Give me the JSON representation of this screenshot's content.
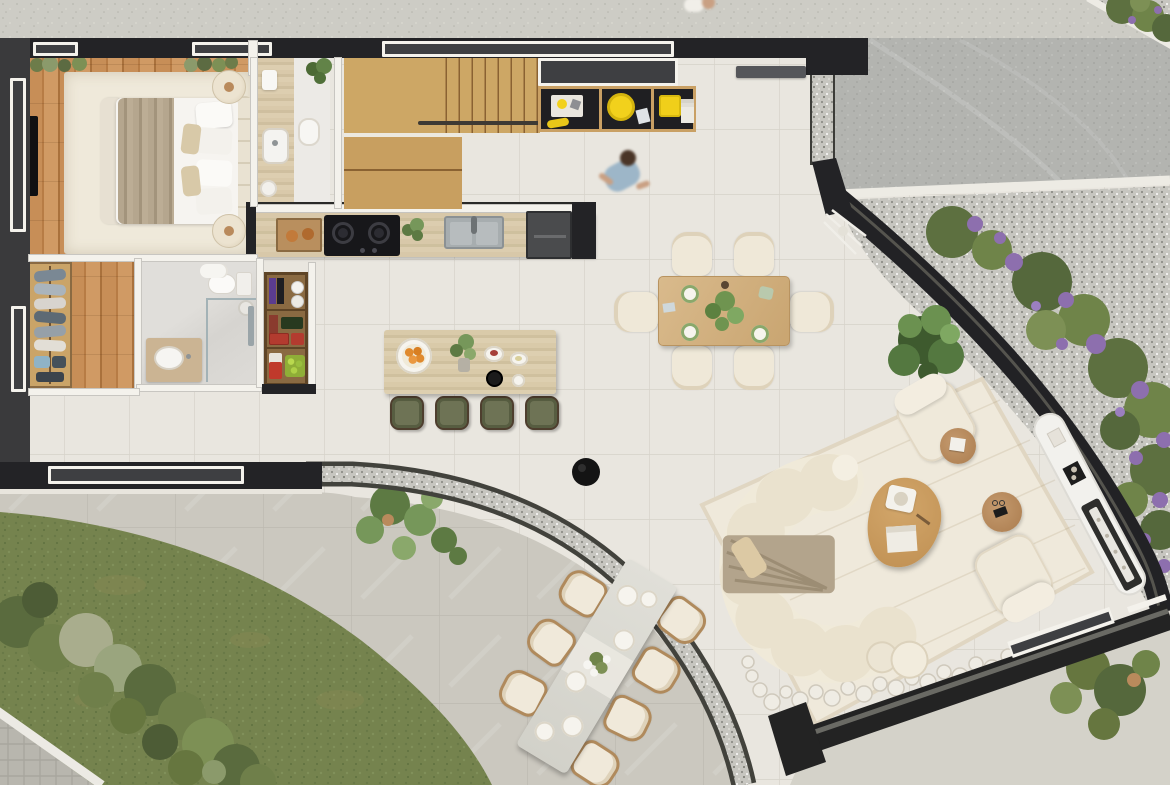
{
  "meta": {
    "description": "photorealistic top-down architectural floor plan rendering of a studio home with garden, driveway and terraces",
    "visible_text": []
  },
  "palette": {
    "wall": "#232326",
    "wall-gray": "#3a3a3c",
    "frame": "#f4f2ec",
    "glass": "#3e3f42",
    "tile": "#e9e6df",
    "patio": "#cbc8bf",
    "patio-se": "#d4d2c9",
    "sidewalk": "#cdccc5",
    "driveway": "#b3b4b0",
    "curb": "#edebe4",
    "gravel": "#c7c6c0",
    "gravel-edge": "#3f3f3b",
    "lawn": "#75834e",
    "shrub-dark": "#4d5c36",
    "shrub": "#66763f",
    "shrub-light": "#8b9a6b",
    "olive-bush": "#a9ad8d",
    "flower": "#8d6fae",
    "wood-floor": "#c08552",
    "stair-wood": "#cda765",
    "shelf-wood": "#c9a064",
    "travertine": "#d7c7a8",
    "oak": "#d4b585",
    "coffee-oak": "#c79b5f",
    "cream": "#efe9db",
    "taupe": "#b5a68e",
    "tan": "#d9c7a2",
    "white": "#f6f5f1",
    "black": "#161618",
    "steel": "#a7adaf",
    "stool": "#6e7355",
    "yellow": "#f2d11c",
    "orange": "#e08a2e",
    "crate-red": "#b33b2f",
    "apple": "#9abf3e",
    "shirt-blue": "#9db6c8",
    "skin": "#c9a083",
    "hair": "#4a3527"
  },
  "scene": {
    "outdoor": [
      "sidewalk-strip",
      "driveway",
      "gravel-planting-bed-with-purple-flowers",
      "corner-planting-bed",
      "lawn",
      "shrub-row",
      "paver-corner",
      "patio",
      "curved-gravel-planter-strip",
      "se-terrace",
      "se-plant"
    ],
    "rooms": [
      "bedroom",
      "ensuite-vanity",
      "bathroom",
      "walk-in-closet",
      "pantry-bar",
      "kitchen",
      "stair",
      "hall",
      "dining-area",
      "living-terrace",
      "outdoor-dining"
    ],
    "furniture": [
      "double-bed",
      "bedroom-rug",
      "tv-panel",
      "poufs",
      "wardrobe-clothes",
      "toilet",
      "shower",
      "vanity-sink",
      "kitchen-counter",
      "cooktop",
      "kitchen-sink",
      "oven-unit",
      "bread-tray",
      "credenza-yellow-dishes",
      "kitchen-island",
      "bar-stools",
      "dining-table",
      "dining-chairs",
      "curved-sofa",
      "coffee-table",
      "armchairs",
      "side-tables",
      "area-rug",
      "marble-console",
      "linear-fireplace",
      "firewood-logs",
      "outdoor-table",
      "outdoor-chairs",
      "black-ottoman",
      "walking-person",
      "potted-plants"
    ]
  }
}
